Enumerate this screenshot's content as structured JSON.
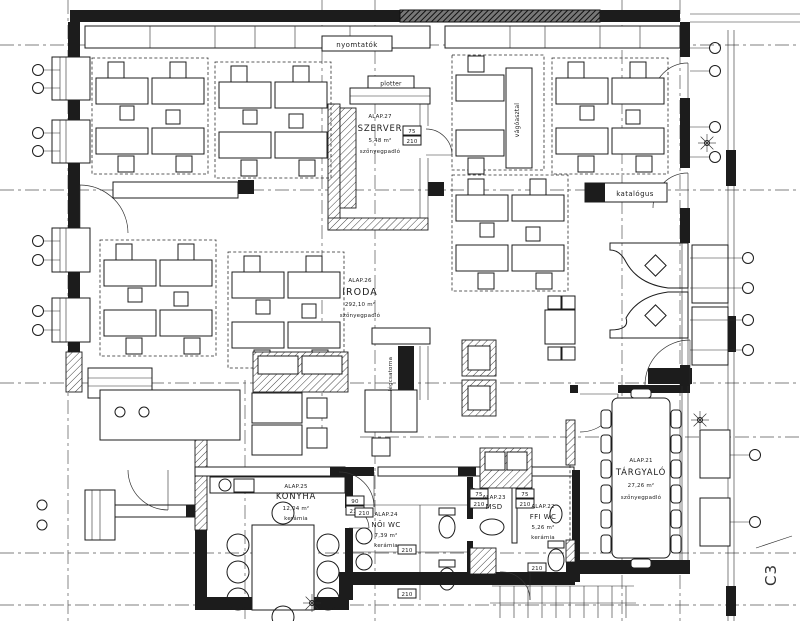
{
  "plan": {
    "rooms": {
      "szerver": {
        "id": "ALAP.27",
        "name": "SZERVER",
        "area": "5,48 m²",
        "floor": "szőnyegpadló"
      },
      "iroda": {
        "id": "ALAP.26",
        "name": "IRODA",
        "area": "292,10 m²",
        "floor": "szőnyegpadló"
      },
      "konyha": {
        "id": "ALAP.25",
        "name": "KONYHA",
        "area": "12,04 m²",
        "floor": "kerámia"
      },
      "noi_wc": {
        "id": "ALAP.24",
        "name": "NŐI WC",
        "area": "7,39 m²",
        "floor": "kerámia"
      },
      "mosdo": {
        "id": "ALAP.23",
        "name": "MSD"
      },
      "ffi_wc": {
        "id": "ALAP.22",
        "name": "FFI WC",
        "area": "5,26 m²",
        "floor": "kerámia"
      },
      "targyalo": {
        "id": "ALAP.21",
        "name": "TÁRGYALÓ",
        "area": "27,26 m²",
        "floor": "szőnyegpadló"
      }
    },
    "labels": {
      "printers": "nyomtatók",
      "plotter": "plotter",
      "cutting_table": "vágóasztal",
      "catalog": "katalógus",
      "duct": "légcsatorna",
      "builtin": "bútorbeépítés",
      "section": "C3"
    },
    "door_dims": {
      "w75": "75",
      "w90": "90",
      "h210": "210"
    },
    "colors": {
      "line": "#1c1c1c",
      "bg": "#ffffff"
    }
  }
}
